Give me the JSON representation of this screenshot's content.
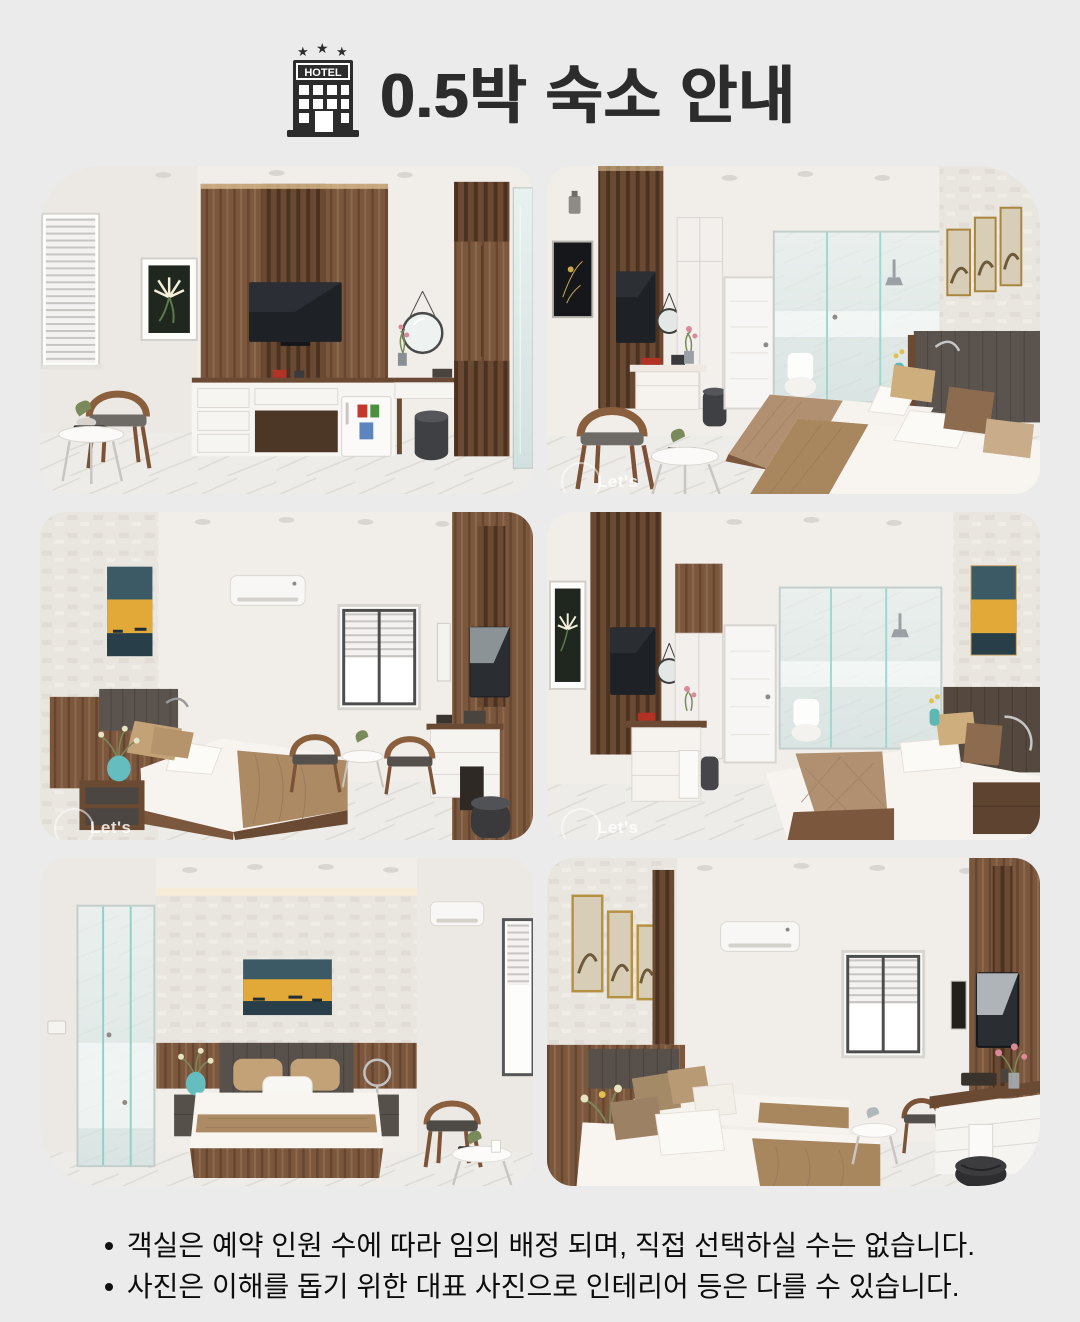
{
  "header": {
    "icon_label": "HOTEL",
    "title": "0.5박 숙소 안내"
  },
  "photos": [
    {
      "name": "room-photo-1",
      "description": "Guest room with wall-mounted TV on wood slat panel, white console, mini fridge, round mirror, wardrobe, lounge chair and side table"
    },
    {
      "name": "room-photo-2",
      "description": "Twin room with two beds, brown throws, glass-walled bathroom, white door, wood TV panel, desk chair and three framed artworks"
    },
    {
      "name": "room-photo-3",
      "description": "Double room with bed, teal vase, air conditioner, window, two chairs with tea table and TV console"
    },
    {
      "name": "room-photo-4",
      "description": "Double room with lily artwork, wood TV panel, white door, glass shower and bed with brown quilt"
    },
    {
      "name": "room-photo-5",
      "description": "Double room with centered bed, glass shower, sunset painting, air conditioner, window, chair and side table"
    },
    {
      "name": "room-photo-6",
      "description": "Twin room with two beds, three framed artworks, teal vase, air conditioner, window and dressing desk with TV"
    }
  ],
  "watermark": {
    "text": "Let's"
  },
  "notes": {
    "items": [
      {
        "text": "객실은 예약 인원 수에 따라 임의 배정 되며, 직접 선택하실 수는 없습니다."
      },
      {
        "text": "사진은 이해를 돕기 위한 대표 사진으로 인테리어 등은 다를 수 있습니다."
      }
    ]
  },
  "colors": {
    "background": "#ebebeb",
    "title_text": "#2c2c2c",
    "body_text": "#0d0d0d",
    "wood": "#7b573e",
    "teal_accent": "#66bdbf",
    "blanket_brown": "#ab8a64"
  }
}
